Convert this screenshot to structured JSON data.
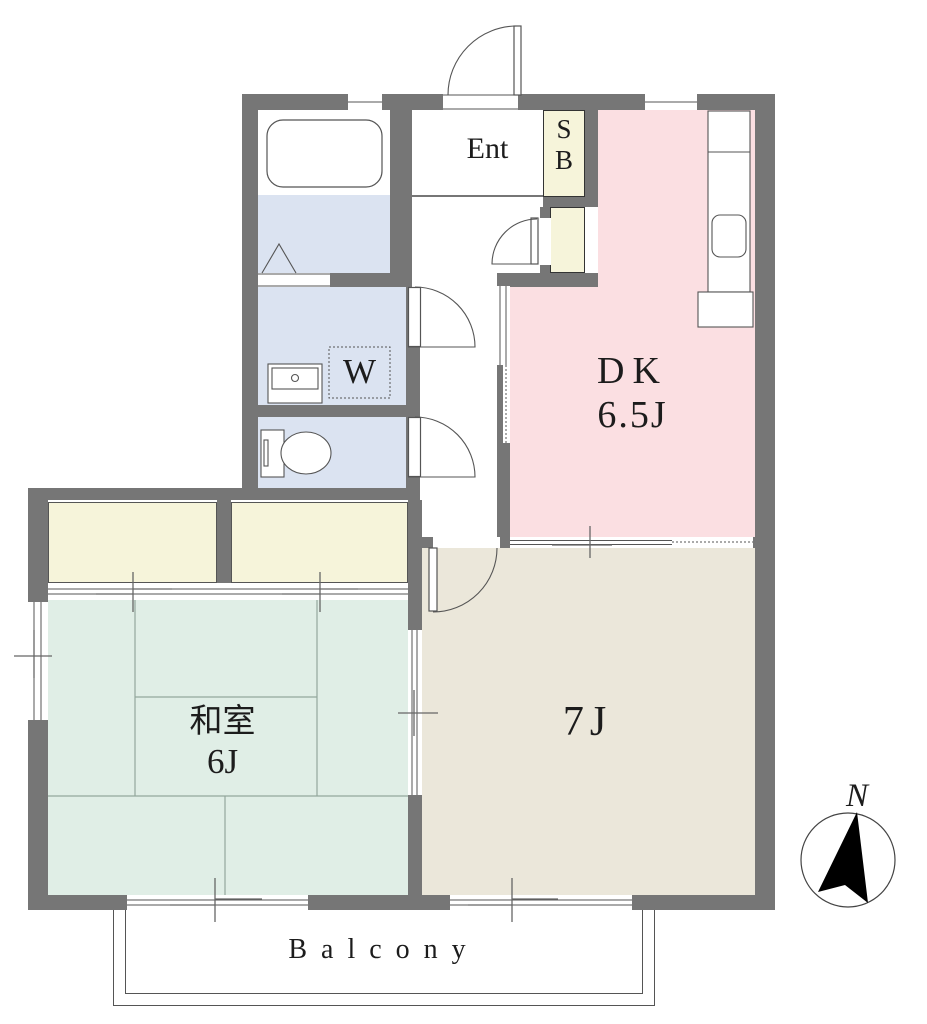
{
  "rooms": {
    "dk": {
      "label": "DK",
      "size": "6.5J"
    },
    "washitsu": {
      "label": "和室",
      "size": "6J"
    },
    "western": {
      "label": "7J"
    },
    "entrance": {
      "label": "Ent"
    },
    "shoebox": {
      "top": "S",
      "bottom": "B"
    },
    "washer": {
      "label": "W"
    },
    "balcony": {
      "label": "Balcony"
    }
  },
  "compass": {
    "label": "N"
  },
  "colors": {
    "wall": "#767676",
    "dk_pink": "#fbdfe2",
    "western_beige": "#ebe7da",
    "tatami_green": "#e0eee6",
    "closet_yellow": "#f6f4da",
    "wet_blue": "#dbe3f1",
    "fixture_line": "#555555"
  }
}
